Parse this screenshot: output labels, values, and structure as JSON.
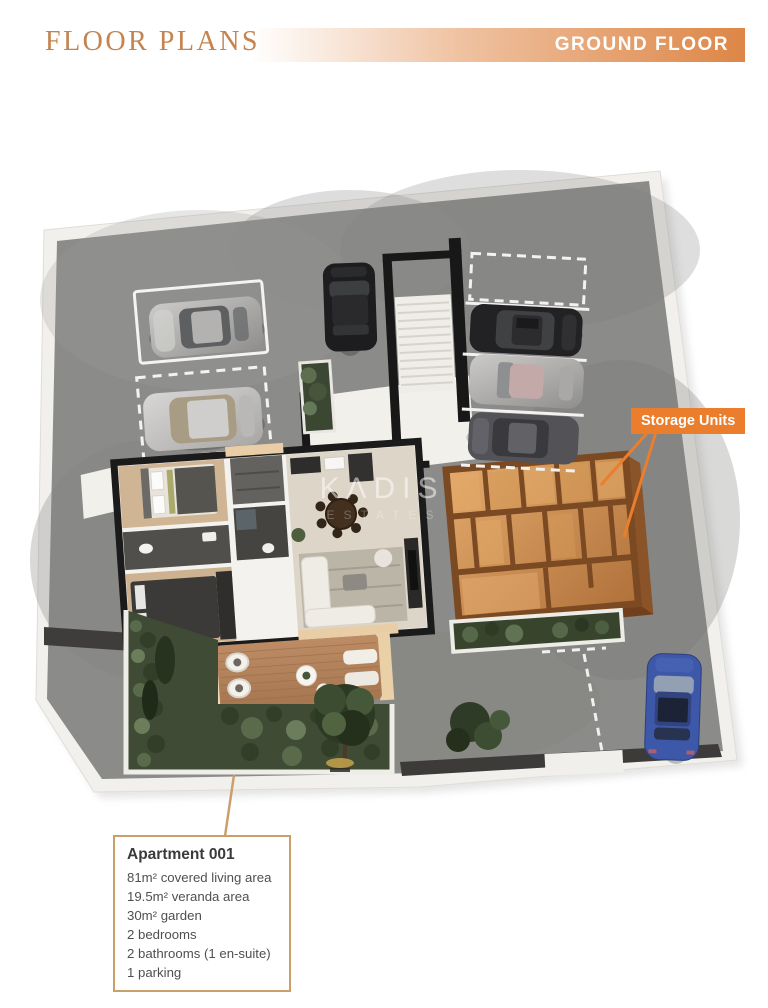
{
  "header": {
    "title": "FLOOR PLANS",
    "banner": "GROUND FLOOR"
  },
  "plan": {
    "storage_label": "Storage Units",
    "watermark": "KΛDIS",
    "watermark_sub": "ESTATES"
  },
  "callout": {
    "title": "Apartment 001",
    "lines": [
      "81m² covered living area",
      "19.5m² veranda area",
      "30m² garden",
      "2 bedrooms",
      "2 bathrooms (1 en-suite)",
      "1 parking"
    ]
  },
  "colors": {
    "accent_orange": "#ea7e2d",
    "header_text": "#c5834f",
    "banner_end": "#dd8646",
    "callout_border": "#c9a06a",
    "storage_brown": "#7b4a23",
    "plot_gray": "#8b8b89",
    "garden_green": "#3f4b35",
    "car_blue": "#3d57a9"
  }
}
